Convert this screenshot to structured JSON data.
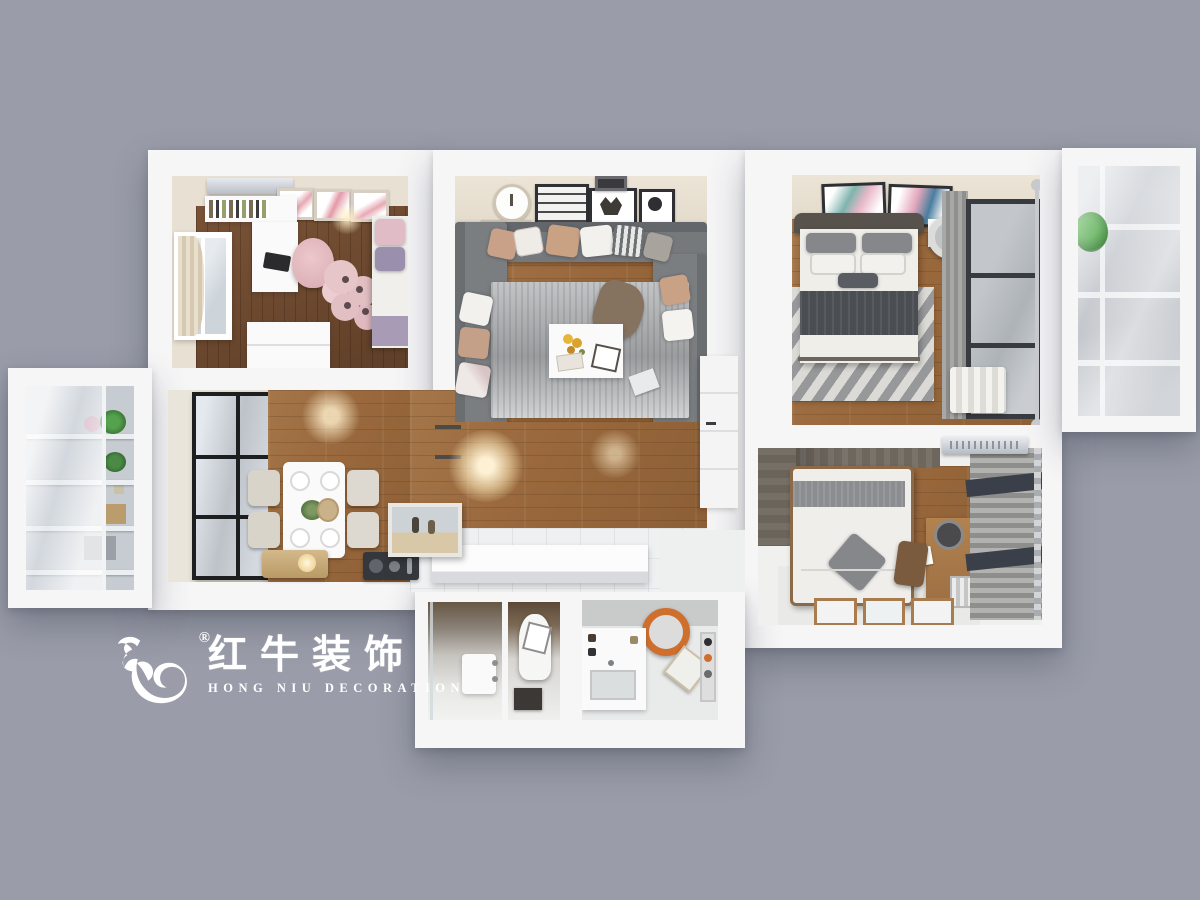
{
  "scene": {
    "type": "3d-top-down-floorplan-render",
    "background_color": "#9a9da9"
  },
  "watermark": {
    "brand_cn": "红牛装饰",
    "brand_en": "HONG NIU DECORATION",
    "registered_mark": "®",
    "color": "#ffffff"
  },
  "rooms": [
    "kids-bedroom-study",
    "dining-kitchen",
    "living-room",
    "hallway",
    "master-bedroom",
    "second-bedroom",
    "bathroom-shower",
    "bathroom-toilet",
    "bathroom-laundry",
    "balcony-left-storage",
    "balcony-right"
  ],
  "palette": {
    "background": "#9a9da9",
    "wall_white": "#f6f6f7",
    "ceiling_beige": "#e9e1d4",
    "wood_floor": "#9c6f44",
    "wood_floor_dark": "#6e4b31",
    "sofa_gray": "#76797c",
    "rug_gray": "#b0b2b4",
    "bedding_white": "#efeeea",
    "blanket_charcoal": "#4a4d52",
    "accent_pink": "#e3bcc4",
    "accent_lilac": "#9b8fae",
    "glass_gray": "#c9ced4",
    "frame_black": "#2e3034",
    "rustic_wall": "#6e675e",
    "desk_wood": "#a97c4f",
    "plant_green": "#3f9b3a",
    "washer_ring_orange": "#cf6f2e"
  }
}
